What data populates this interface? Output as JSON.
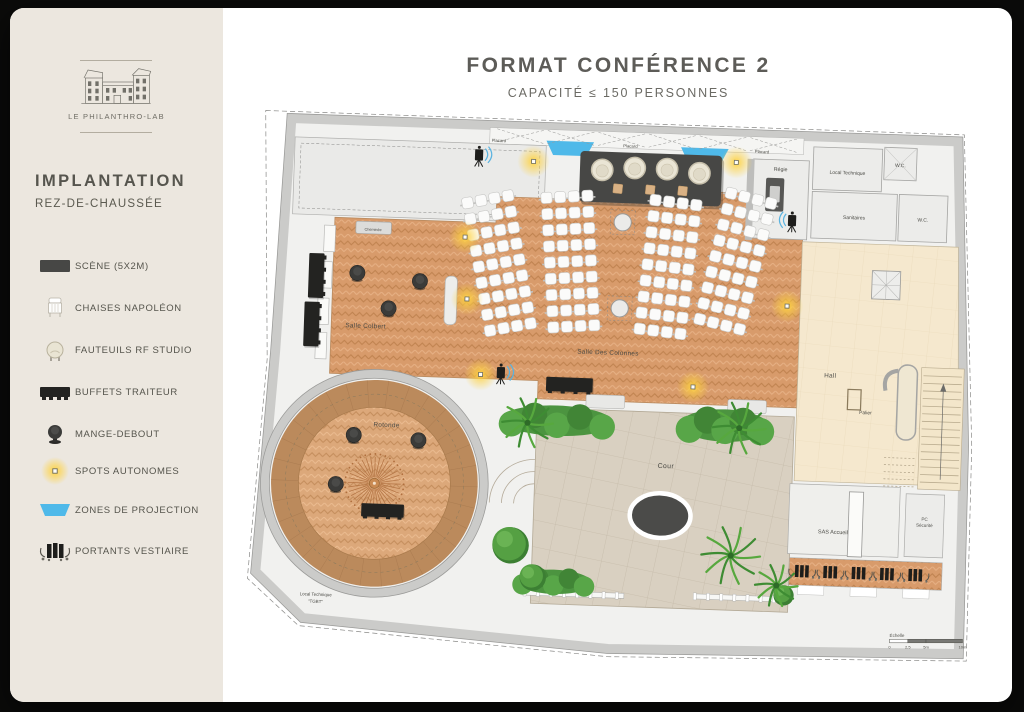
{
  "brand": {
    "name": "LE PHILANTHRO-LAB"
  },
  "sidebar": {
    "title": "IMPLANTATION",
    "subtitle": "REZ-DE-CHAUSSÉE",
    "legend": [
      {
        "icon": "stage-icon",
        "label": "SCÈNE (5X2M)"
      },
      {
        "icon": "napoleon-chair-icon",
        "label": "CHAISES NAPOLÉON"
      },
      {
        "icon": "armchair-icon",
        "label": "FAUTEUILS RF STUDIO"
      },
      {
        "icon": "buffet-icon",
        "label": "BUFFETS TRAITEUR"
      },
      {
        "icon": "standing-table-icon",
        "label": "MANGE-DEBOUT"
      },
      {
        "icon": "spot-icon",
        "label": "SPOTS AUTONOMES"
      },
      {
        "icon": "projection-icon",
        "label": "ZONES DE PROJECTION"
      },
      {
        "icon": "coat-rack-icon",
        "label": "PORTANTS VESTIAIRE"
      }
    ]
  },
  "header": {
    "title": "FORMAT CONFÉRENCE 2",
    "subtitle": "CAPACITÉ ≤ 150 PERSONNES"
  },
  "plan": {
    "rooms": {
      "salle_colbert": "Salle Colbert",
      "salle_des_colonnes": "Salle Des Colonnes",
      "rotonde": "Rotonde",
      "cour": "Cour",
      "hall": "Hall",
      "palier": "Palier",
      "regie": "Régie",
      "sas_accueil": "SAS Accueil",
      "pc_line1": "PC",
      "pc_line2": "Sécurité",
      "sanitaires": "Sanitaires",
      "local_technique": "Local Technique",
      "tgbt_line1": "Local Technique",
      "tgbt_line2": "\"TGBT\"",
      "wc": "W.C.",
      "placard": "Placard",
      "cheminee": "Cheminée"
    },
    "scale": {
      "label": "Échelle",
      "ticks": [
        "0",
        "2,5",
        "5m",
        "10m"
      ]
    },
    "palette": {
      "wood": "#d89b6b",
      "wood_line": "#c08350",
      "wood_light": "#e7b185",
      "rotonde_ring": "#bb8a5c",
      "rotonde_inner": "#dca87a",
      "court": "#d9d0c1",
      "court_line": "#c6bbaa",
      "hall": "#f5e8ce",
      "wall": "#c9c9c7",
      "stage": "#474745",
      "projection": "#4fb9e9",
      "spot": "#ffd23e",
      "chair": "#fbfbfa",
      "buffet": "#232321",
      "green_dark": "#3e8c33",
      "green_light": "#57a83e"
    },
    "rotonde_geo": {
      "cx": 94,
      "cy": 357,
      "r_wall": 108,
      "r_ring": 102,
      "r_inner": 75
    },
    "furniture": {
      "stage": {
        "x": 286,
        "y": 22,
        "w": 140,
        "h": 50
      },
      "armchairs": [
        [
          308,
          40
        ],
        [
          340,
          37
        ],
        [
          372,
          37
        ],
        [
          404,
          40
        ]
      ],
      "stage_tables": [
        [
          324,
          58
        ],
        [
          356,
          58
        ],
        [
          388,
          58
        ]
      ],
      "projection_zones": [
        [
          252,
          13,
          47,
          14
        ],
        [
          385,
          15,
          47,
          14
        ]
      ],
      "buffets": [
        {
          "x": 22,
          "y": 132,
          "w": 15,
          "h": 44,
          "dir": "v"
        },
        {
          "x": 19,
          "y": 180,
          "w": 15,
          "h": 44,
          "dir": "v"
        },
        {
          "x": 260,
          "y": 246,
          "w": 46,
          "h": 14,
          "dir": "h"
        },
        {
          "x": 82,
          "y": 377,
          "w": 42,
          "h": 13,
          "dir": "h"
        }
      ],
      "standing_tables": [
        [
          70,
          150
        ],
        [
          132,
          156
        ],
        [
          102,
          184
        ],
        [
          72,
          310
        ],
        [
          136,
          313
        ],
        [
          56,
          359
        ]
      ],
      "columns": [
        [
          330,
          91
        ],
        [
          330,
          176
        ]
      ],
      "spots": [
        [
          240,
          34
        ],
        [
          440,
          28
        ],
        [
          175,
          111
        ],
        [
          179,
          172
        ],
        [
          195,
          246
        ],
        [
          405,
          251
        ],
        [
          495,
          168
        ]
      ],
      "speakers": [
        [
          186,
          31,
          1
        ],
        [
          497,
          85,
          -1
        ],
        [
          215,
          245,
          1
        ]
      ],
      "seating_blocks": [
        {
          "cx": 210,
          "cy": 138,
          "rot": -12,
          "cols": 4,
          "rows": 9
        },
        {
          "cx": 280,
          "cy": 134,
          "rot": -5,
          "cols": 4,
          "rows": 9
        },
        {
          "cx": 376,
          "cy": 136,
          "rot": 5,
          "cols": 4,
          "rows": 9
        },
        {
          "cx": 442,
          "cy": 128,
          "rot": 12,
          "cols": 4,
          "rows": 9
        }
      ],
      "racks": [
        [
          519,
          429
        ],
        [
          547,
          429
        ],
        [
          575,
          429
        ],
        [
          603,
          429
        ],
        [
          631,
          429
        ]
      ]
    },
    "greenery": {
      "hedges": [
        [
          272,
          289,
          112,
          30
        ],
        [
          438,
          288,
          88,
          32
        ],
        [
          274,
          448,
          76,
          24
        ]
      ],
      "palms": [
        [
          243,
          292,
          25
        ],
        [
          452,
          290,
          26
        ],
        [
          448,
          416,
          29
        ],
        [
          494,
          444,
          21
        ]
      ],
      "trees": [
        [
          229,
          412,
          18
        ],
        [
          252,
          443,
          13
        ],
        [
          500,
          452,
          10
        ]
      ]
    },
    "fences": [
      [
        246,
        457,
        98
      ],
      [
        414,
        455,
        92
      ]
    ]
  }
}
